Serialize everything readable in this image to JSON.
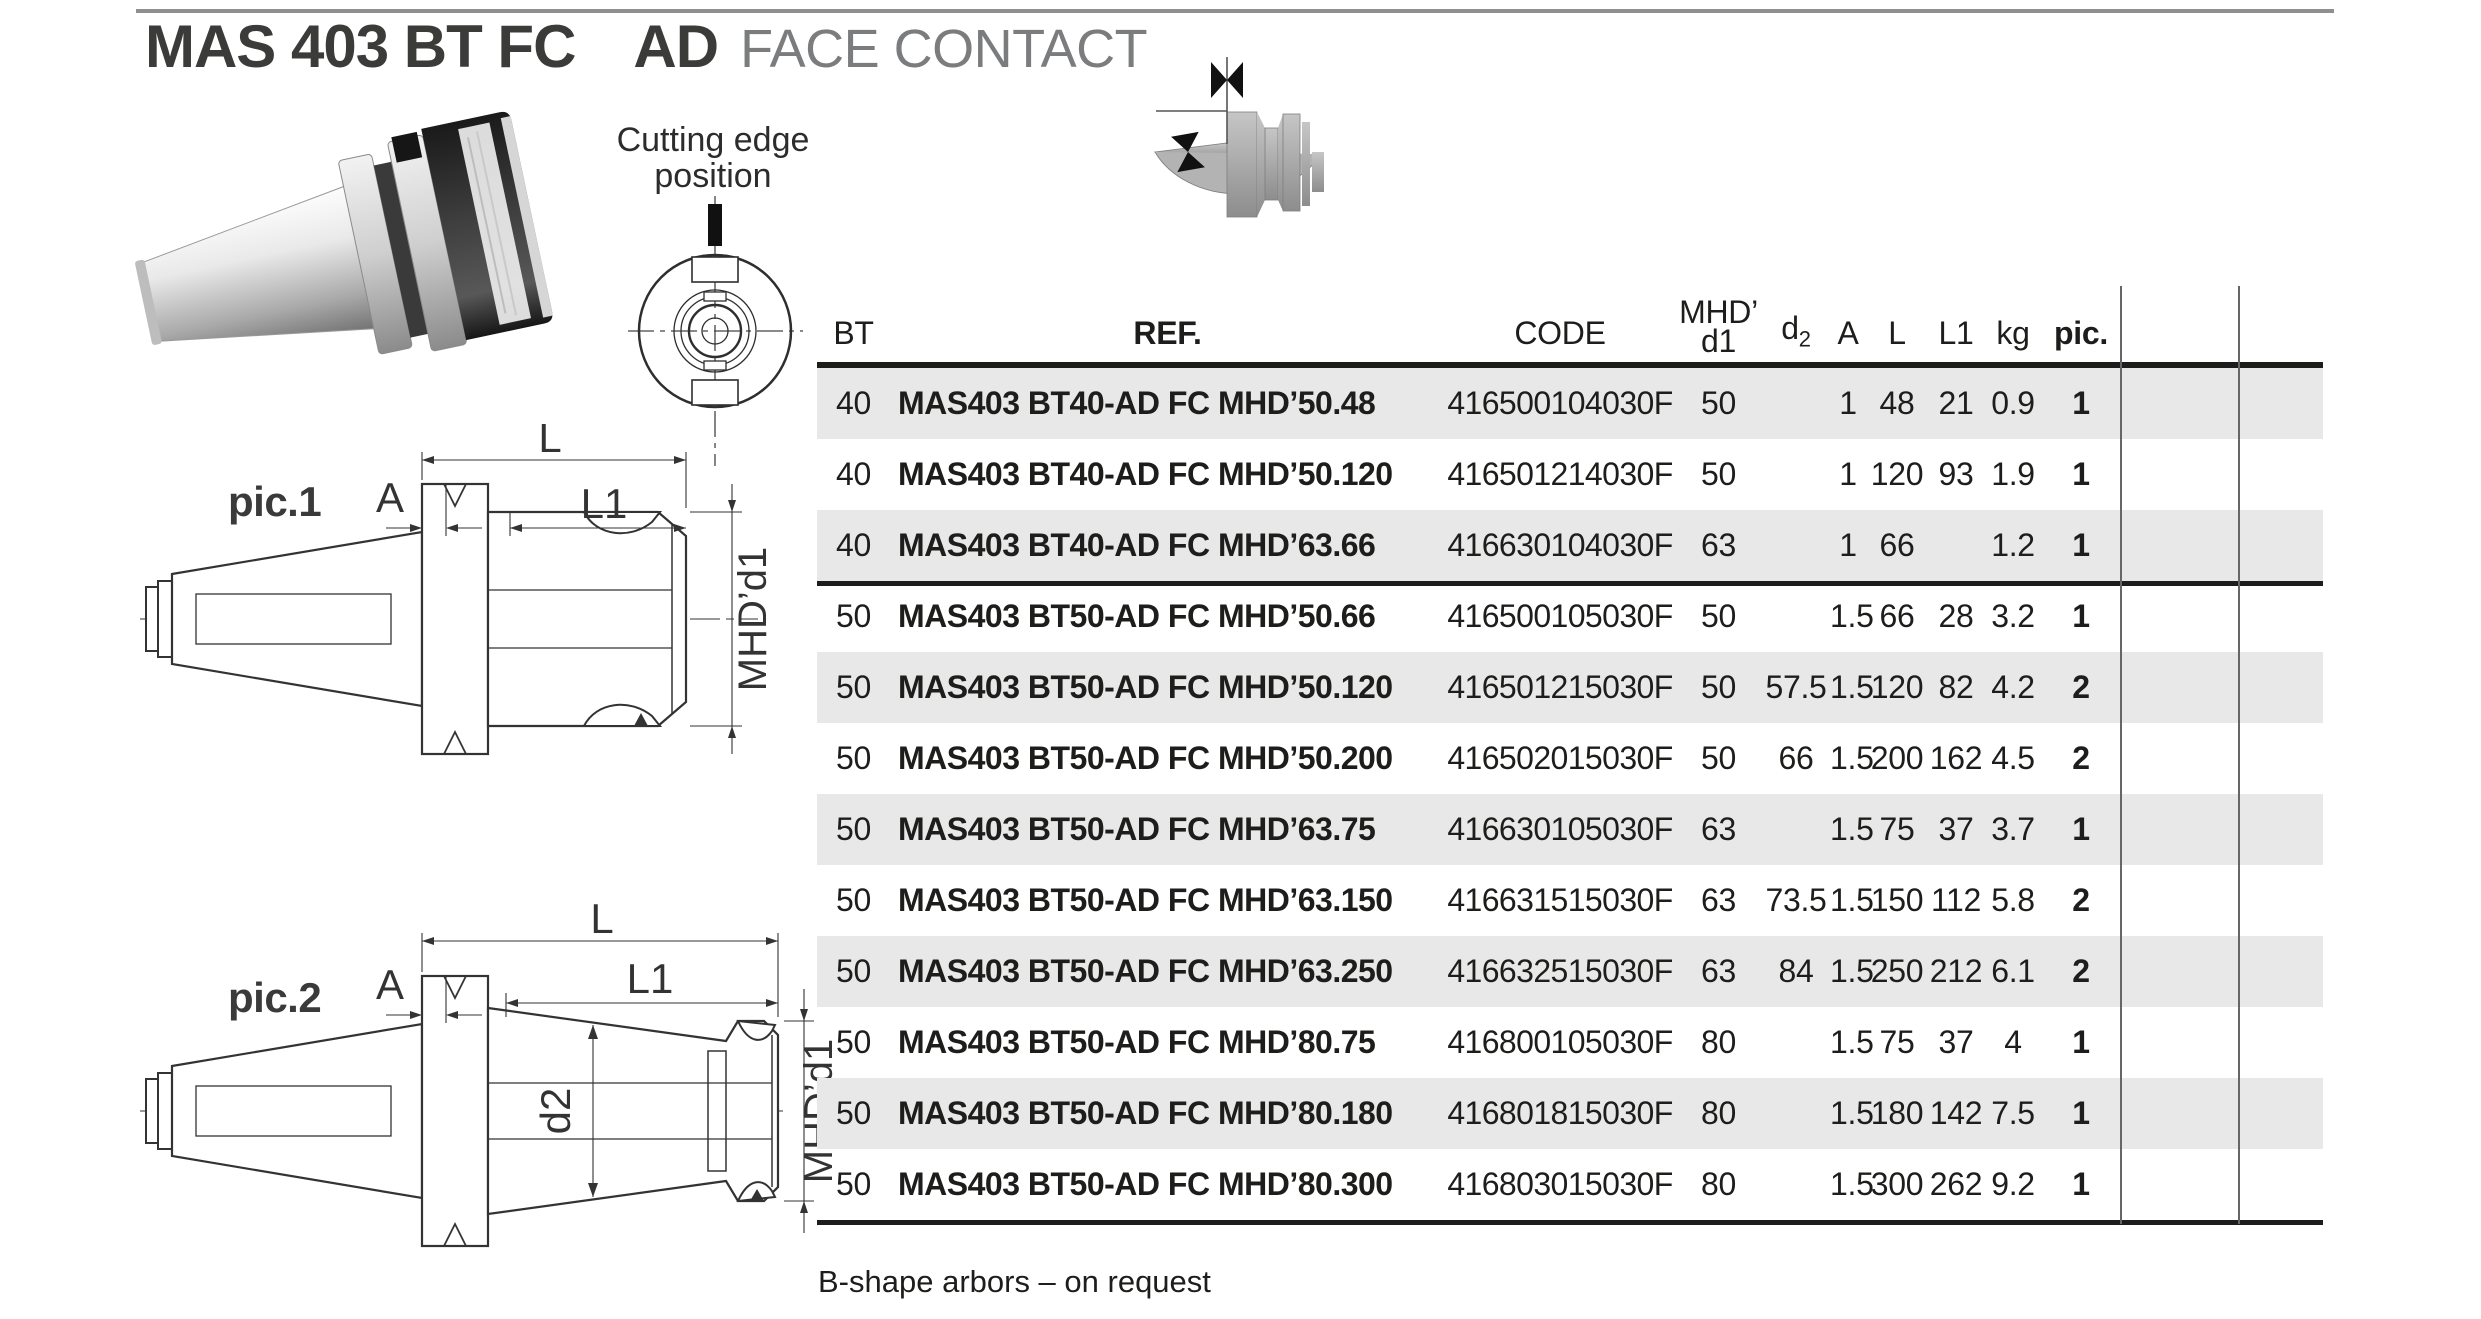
{
  "header": {
    "title_main": "MAS 403 BT FC",
    "title_code": "AD",
    "title_desc": "FACE CONTACT"
  },
  "cutting_edge": {
    "label_line1": "Cutting edge",
    "label_line2": "position"
  },
  "pic1": {
    "label": "pic.1",
    "dims": {
      "l": "L",
      "a": "A",
      "l1": "L1",
      "mhd": "MHD’d1"
    }
  },
  "pic2": {
    "label": "pic.2",
    "dims": {
      "l": "L",
      "a": "A",
      "l1": "L1",
      "d2": "d2",
      "mhd": "MHD’d1"
    }
  },
  "table": {
    "headers": {
      "bt": "BT",
      "ref": "REF.",
      "code": "CODE",
      "mhd_line1": "MHD’",
      "mhd_line2": "d1",
      "d2_base": "d",
      "d2_sub": "2",
      "a": "A",
      "l": "L",
      "l1": "L1",
      "kg": "kg",
      "pic": "pic."
    },
    "group_break_after_index": 2,
    "rows": [
      {
        "bt": "40",
        "ref": "MAS403 BT40-AD FC MHD’50.48",
        "code": "416500104030F",
        "d1": "50",
        "d2": "",
        "a": "1",
        "l": "48",
        "l1": "21",
        "kg": "0.9",
        "pic": "1"
      },
      {
        "bt": "40",
        "ref": "MAS403 BT40-AD FC MHD’50.120",
        "code": "416501214030F",
        "d1": "50",
        "d2": "",
        "a": "1",
        "l": "120",
        "l1": "93",
        "kg": "1.9",
        "pic": "1"
      },
      {
        "bt": "40",
        "ref": "MAS403 BT40-AD FC MHD’63.66",
        "code": "416630104030F",
        "d1": "63",
        "d2": "",
        "a": "1",
        "l": "66",
        "l1": "",
        "kg": "1.2",
        "pic": "1"
      },
      {
        "bt": "50",
        "ref": "MAS403 BT50-AD FC MHD’50.66",
        "code": "416500105030F",
        "d1": "50",
        "d2": "",
        "a": "1.5",
        "l": "66",
        "l1": "28",
        "kg": "3.2",
        "pic": "1"
      },
      {
        "bt": "50",
        "ref": "MAS403 BT50-AD FC MHD’50.120",
        "code": "416501215030F",
        "d1": "50",
        "d2": "57.5",
        "a": "1.5",
        "l": "120",
        "l1": "82",
        "kg": "4.2",
        "pic": "2"
      },
      {
        "bt": "50",
        "ref": "MAS403 BT50-AD FC MHD’50.200",
        "code": "416502015030F",
        "d1": "50",
        "d2": "66",
        "a": "1.5",
        "l": "200",
        "l1": "162",
        "kg": "4.5",
        "pic": "2"
      },
      {
        "bt": "50",
        "ref": "MAS403 BT50-AD FC MHD’63.75",
        "code": "416630105030F",
        "d1": "63",
        "d2": "",
        "a": "1.5",
        "l": "75",
        "l1": "37",
        "kg": "3.7",
        "pic": "1"
      },
      {
        "bt": "50",
        "ref": "MAS403 BT50-AD FC MHD’63.150",
        "code": "416631515030F",
        "d1": "63",
        "d2": "73.5",
        "a": "1.5",
        "l": "150",
        "l1": "112",
        "kg": "5.8",
        "pic": "2"
      },
      {
        "bt": "50",
        "ref": "MAS403 BT50-AD FC MHD’63.250",
        "code": "416632515030F",
        "d1": "63",
        "d2": "84",
        "a": "1.5",
        "l": "250",
        "l1": "212",
        "kg": "6.1",
        "pic": "2"
      },
      {
        "bt": "50",
        "ref": "MAS403 BT50-AD FC MHD’80.75",
        "code": "416800105030F",
        "d1": "80",
        "d2": "",
        "a": "1.5",
        "l": "75",
        "l1": "37",
        "kg": "4",
        "pic": "1"
      },
      {
        "bt": "50",
        "ref": "MAS403 BT50-AD FC MHD’80.180",
        "code": "416801815030F",
        "d1": "80",
        "d2": "",
        "a": "1.5",
        "l": "180",
        "l1": "142",
        "kg": "7.5",
        "pic": "1"
      },
      {
        "bt": "50",
        "ref": "MAS403 BT50-AD FC MHD’80.300",
        "code": "416803015030F",
        "d1": "80",
        "d2": "",
        "a": "1.5",
        "l": "300",
        "l1": "262",
        "kg": "9.2",
        "pic": "1"
      }
    ]
  },
  "footer": {
    "note": "B-shape arbors – on request"
  },
  "colors": {
    "row_stripe": "#e8e8e8",
    "rule_gray": "#8f8f8f",
    "text_dark": "#1d1d1b",
    "title_gray": "#7b7c7e",
    "line_thin": "#666666"
  }
}
